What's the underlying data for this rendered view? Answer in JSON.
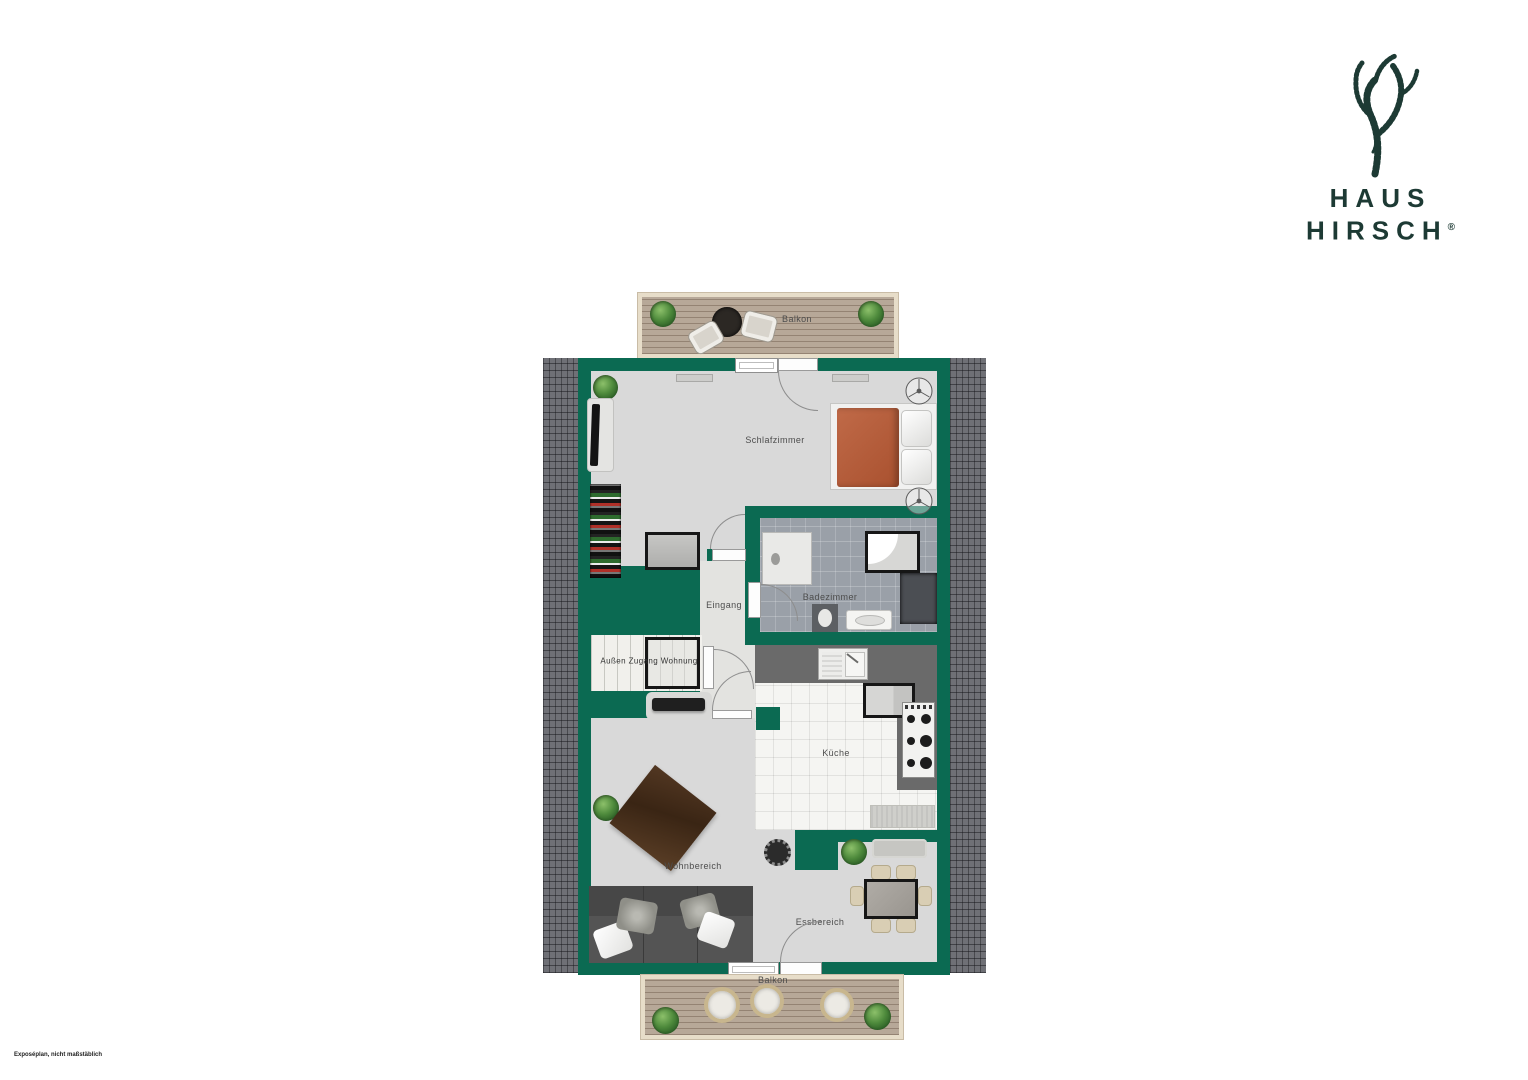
{
  "logo": {
    "line1": "HAUS",
    "line2": "HIRSCH",
    "registered": "®",
    "color": "#1d3a34"
  },
  "plan": {
    "labels": {
      "balkon_top": "Balkon",
      "schlafzimmer": "Schlafzimmer",
      "badezimmer": "Badezimmer",
      "eingang": "Eingang",
      "aussen_zugang_wohnung": "Außen Zugang Wohnung",
      "kueche": "Küche",
      "wohnbereich": "Wohnbereich",
      "essbereich": "Essbereich",
      "balkon_bottom": "Balkon"
    },
    "colors": {
      "wall": "#0b6a52",
      "floor": "#d9d9d9",
      "bath_tile": "#9aa0a8",
      "kitchen_tile": "#f5f5f2",
      "roof": "#6f7076",
      "deck": "#b7a898",
      "bed_accent": "#b65a3c"
    }
  },
  "footer": {
    "disclaimer": "Exposéplan, nicht maßstäblich"
  }
}
